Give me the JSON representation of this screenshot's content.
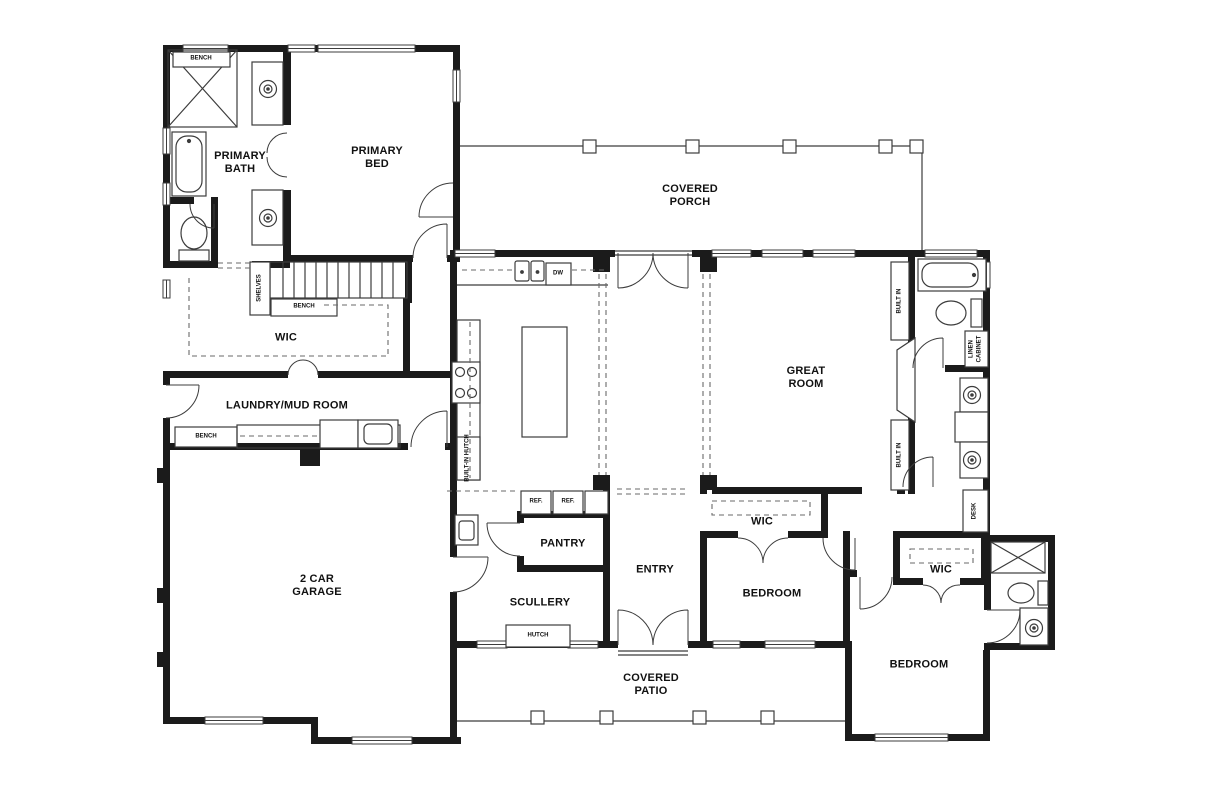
{
  "rooms": {
    "primary_bath": "PRIMARY BATH",
    "primary_bed": "PRIMARY BED",
    "covered_porch": "COVERED PORCH",
    "wic_primary": "WIC",
    "laundry_mud_room": "LAUNDRY/MUD ROOM",
    "great_room": "GREAT ROOM",
    "garage": "2 CAR GARAGE",
    "pantry": "PANTRY",
    "scullery": "SCULLERY",
    "entry": "ENTRY",
    "bedroom_1": "BEDROOM",
    "wic_bedroom_1": "WIC",
    "bedroom_2": "BEDROOM",
    "wic_bedroom_2": "WIC",
    "covered_patio": "COVERED PATIO"
  },
  "fixtures": {
    "bench_shower": "BENCH",
    "shelves": "SHELVES",
    "bench_stairs": "BENCH",
    "bench_mudroom": "BENCH",
    "dishwasher": "DW",
    "fridge_1": "REF.",
    "fridge_2": "REF.",
    "hutch": "HUTCH",
    "built_in_hutch": "BUILT-IN HUTCH",
    "built_in_upper": "BUILT IN",
    "built_in_lower": "BUILT IN",
    "linen_cabinet": "LINEN CABINET",
    "desk": "DESK"
  },
  "colors": {
    "walls": "#1b1b1b",
    "lines": "#3c3c3c",
    "dashed": "#6a6a6a",
    "background": "#ffffff"
  }
}
